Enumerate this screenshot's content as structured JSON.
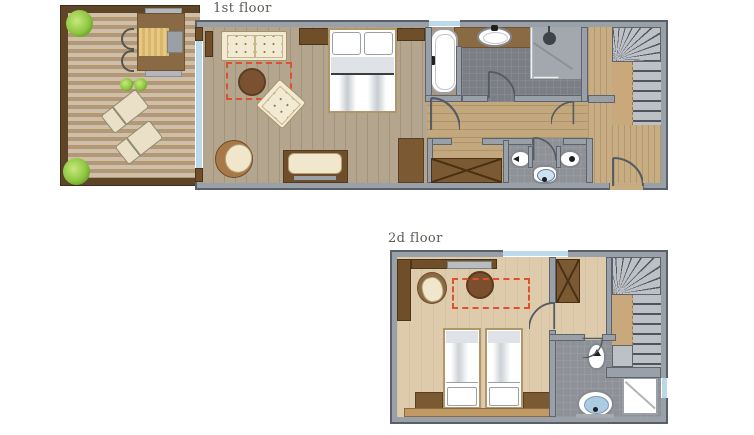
{
  "first_floor": {
    "label": "1st floor",
    "rooms": [
      "terrace",
      "living-bedroom",
      "bathroom",
      "shower",
      "wc",
      "closet",
      "corridor",
      "hall",
      "stairs"
    ],
    "furniture": [
      "sofa",
      "coffee-table",
      "armchair",
      "papasan-chair",
      "bench",
      "double-bed",
      "wardrobe",
      "dining-table",
      "sun-lounger",
      "sun-lounger",
      "plants",
      "bathtub",
      "washbasin",
      "shower-head",
      "toilet",
      "bidet",
      "wc-basin"
    ]
  },
  "second_floor": {
    "label": "2d floor",
    "rooms": [
      "bedroom",
      "hall",
      "stairs",
      "bathroom",
      "shower"
    ],
    "furniture": [
      "twin-bed",
      "twin-bed",
      "nightstand",
      "nightstand",
      "armchair",
      "round-table",
      "wardrobe",
      "shelf",
      "toilet",
      "washbasin",
      "shower-tray"
    ]
  },
  "palette": {
    "wall": "#99a0a8",
    "wall_edge": "#5d646e",
    "deck_light": "#cfbfa8",
    "deck_dark": "#b29877",
    "terrace_frame": "#5e4527",
    "dark_wood": "#6f4f2a",
    "cream": "#f2ead2",
    "table_brown": "#7b5231",
    "rug_dashed_red": "#dd5030",
    "floor_living": "#b4a68e",
    "floor_corridor": "#c3a87e",
    "floor_bedroom2": "#ddcbac",
    "bath_tile_dark": "#7b7e84",
    "shower_gray": "#a3a8ae",
    "stair_step": "#bdc1c6",
    "stair_wood": "#c9a97c",
    "window_blue": "#bcd9ec",
    "plant_green": "#8cc63f",
    "label_text": "#5b5b54"
  }
}
